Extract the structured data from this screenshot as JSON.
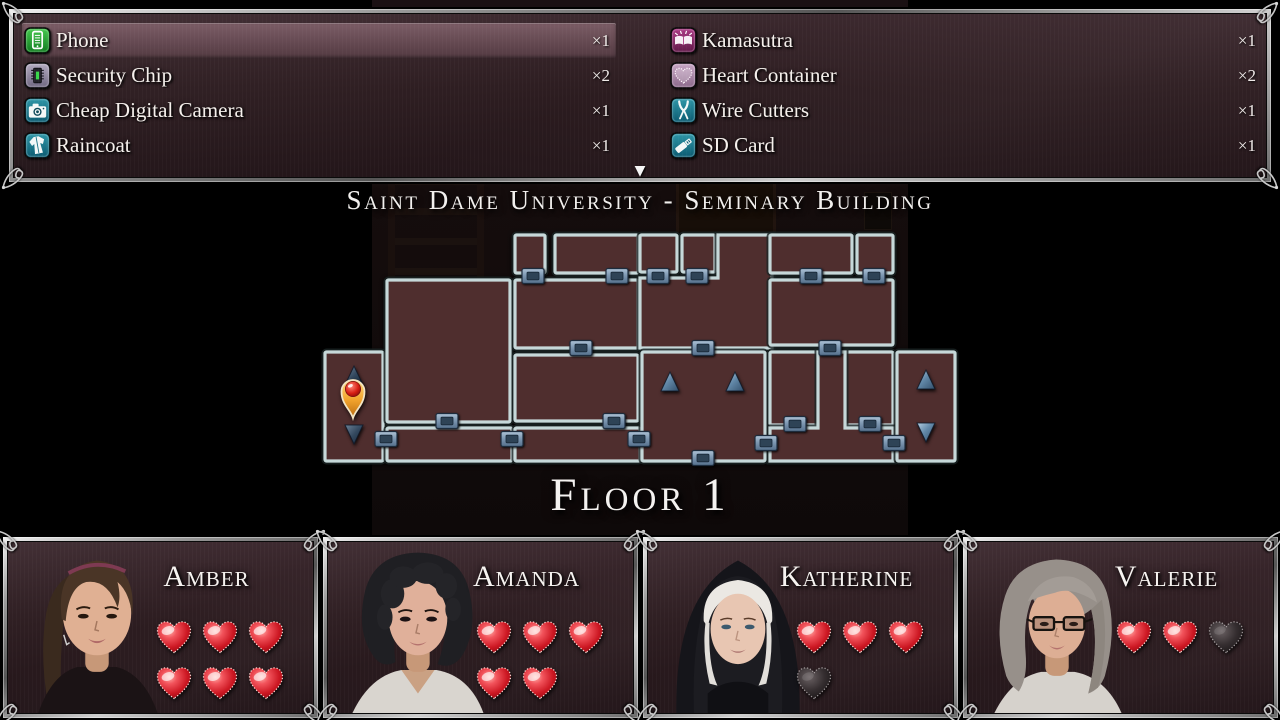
{
  "inventory": {
    "columns": [
      {
        "items": [
          {
            "icon": "phone",
            "label": "Phone",
            "count": "×1",
            "selected": true
          },
          {
            "icon": "security-chip",
            "label": "Security Chip",
            "count": "×2",
            "selected": false
          },
          {
            "icon": "camera",
            "label": "Cheap Digital Camera",
            "count": "×1",
            "selected": false
          },
          {
            "icon": "raincoat",
            "label": "Raincoat",
            "count": "×1",
            "selected": false
          }
        ]
      },
      {
        "items": [
          {
            "icon": "kamasutra",
            "label": "Kamasutra",
            "count": "×1",
            "selected": false
          },
          {
            "icon": "heart-container",
            "label": "Heart Container",
            "count": "×2",
            "selected": false
          },
          {
            "icon": "wire-cutters",
            "label": "Wire Cutters",
            "count": "×1",
            "selected": false
          },
          {
            "icon": "sd-card",
            "label": "SD Card",
            "count": "×1",
            "selected": false
          }
        ]
      }
    ],
    "scroll_indicator": "▼"
  },
  "map": {
    "title": "Saint Dame University - Seminary Building",
    "floor_label": "Floor 1",
    "colors": {
      "room_fill": "#4f2e2e",
      "room_stroke": "#c6d8d9",
      "door_steel": "#7e98b2",
      "stairs_blue": "#6288a8",
      "marker_ball": "#d81f14",
      "marker_body": "#f2a32c"
    },
    "rooms": [
      {
        "name": "stairwell-west",
        "type": "rect",
        "x": 3,
        "y": 120,
        "w": 58,
        "h": 109
      },
      {
        "name": "large-room-west",
        "type": "rect",
        "x": 65,
        "y": 48,
        "w": 123,
        "h": 142
      },
      {
        "name": "corridor-west",
        "type": "rect",
        "x": 65,
        "y": 196,
        "w": 125,
        "h": 33
      },
      {
        "name": "corridor-center",
        "type": "rect",
        "x": 193,
        "y": 196,
        "w": 125,
        "h": 33
      },
      {
        "name": "small-room-1",
        "type": "rect",
        "x": 193,
        "y": 3,
        "w": 30,
        "h": 38
      },
      {
        "name": "small-room-2",
        "type": "rect",
        "x": 233,
        "y": 3,
        "w": 83,
        "h": 38
      },
      {
        "name": "room-mid-west",
        "type": "rect",
        "x": 193,
        "y": 48,
        "w": 123,
        "h": 68
      },
      {
        "name": "room-lower-west",
        "type": "rect",
        "x": 193,
        "y": 123,
        "w": 123,
        "h": 66
      },
      {
        "name": "small-room-3",
        "type": "rect",
        "x": 318,
        "y": 3,
        "w": 37,
        "h": 37
      },
      {
        "name": "small-room-4",
        "type": "rect",
        "x": 360,
        "y": 3,
        "w": 33,
        "h": 37
      },
      {
        "name": "room-center",
        "type": "poly",
        "points": "396,3 450,3 450,116 318,116 318,46 396,46"
      },
      {
        "name": "stair-hall-center",
        "type": "rect",
        "x": 320,
        "y": 120,
        "w": 123,
        "h": 109
      },
      {
        "name": "small-room-5",
        "type": "rect",
        "x": 448,
        "y": 3,
        "w": 82,
        "h": 38
      },
      {
        "name": "small-room-6",
        "type": "rect",
        "x": 535,
        "y": 3,
        "w": 36,
        "h": 38
      },
      {
        "name": "room-mid-east",
        "type": "rect",
        "x": 448,
        "y": 48,
        "w": 123,
        "h": 65
      },
      {
        "name": "room-lower-east-1",
        "type": "rect",
        "x": 448,
        "y": 120,
        "w": 48,
        "h": 73
      },
      {
        "name": "room-lower-east-2",
        "type": "rect",
        "x": 523,
        "y": 120,
        "w": 48,
        "h": 73
      },
      {
        "name": "corridor-east",
        "type": "poly",
        "points": "496,120 523,120 523,196 571,196 571,229 448,229 448,196 496,196"
      },
      {
        "name": "stairwell-east",
        "type": "rect",
        "x": 575,
        "y": 120,
        "w": 58,
        "h": 109
      }
    ],
    "doors": [
      [
        211,
        44
      ],
      [
        295,
        44
      ],
      [
        336,
        44
      ],
      [
        375,
        44
      ],
      [
        489,
        44
      ],
      [
        552,
        44
      ],
      [
        259,
        116
      ],
      [
        381,
        116
      ],
      [
        508,
        116
      ],
      [
        125,
        189
      ],
      [
        292,
        189
      ],
      [
        473,
        192
      ],
      [
        548,
        192
      ],
      [
        64,
        207
      ],
      [
        190,
        207
      ],
      [
        317,
        207
      ],
      [
        444,
        211
      ],
      [
        572,
        211
      ],
      [
        381,
        226
      ]
    ],
    "stairs": [
      {
        "x": 348,
        "y": 150,
        "dir": "up",
        "tone": "steel"
      },
      {
        "x": 413,
        "y": 150,
        "dir": "up",
        "tone": "steel"
      },
      {
        "x": 604,
        "y": 148,
        "dir": "up",
        "tone": "steel"
      },
      {
        "x": 604,
        "y": 200,
        "dir": "down",
        "tone": "steel"
      },
      {
        "x": 32,
        "y": 144,
        "dir": "up",
        "tone": "dark"
      },
      {
        "x": 32,
        "y": 202,
        "dir": "down",
        "tone": "dark"
      }
    ],
    "marker": {
      "x": 31,
      "y": 158
    }
  },
  "characters": [
    {
      "name": "Amber",
      "portrait": "amber",
      "hearts": [
        [
          "full",
          "full",
          "full"
        ],
        [
          "full",
          "full",
          "full"
        ]
      ]
    },
    {
      "name": "Amanda",
      "portrait": "amanda",
      "hearts": [
        [
          "full",
          "full",
          "full"
        ],
        [
          "full",
          "full"
        ]
      ]
    },
    {
      "name": "Katherine",
      "portrait": "katherine",
      "hearts": [
        [
          "full",
          "full",
          "full"
        ],
        [
          "empty"
        ]
      ]
    },
    {
      "name": "Valerie",
      "portrait": "valerie",
      "hearts": [
        [
          "full",
          "full",
          "empty"
        ]
      ]
    }
  ]
}
